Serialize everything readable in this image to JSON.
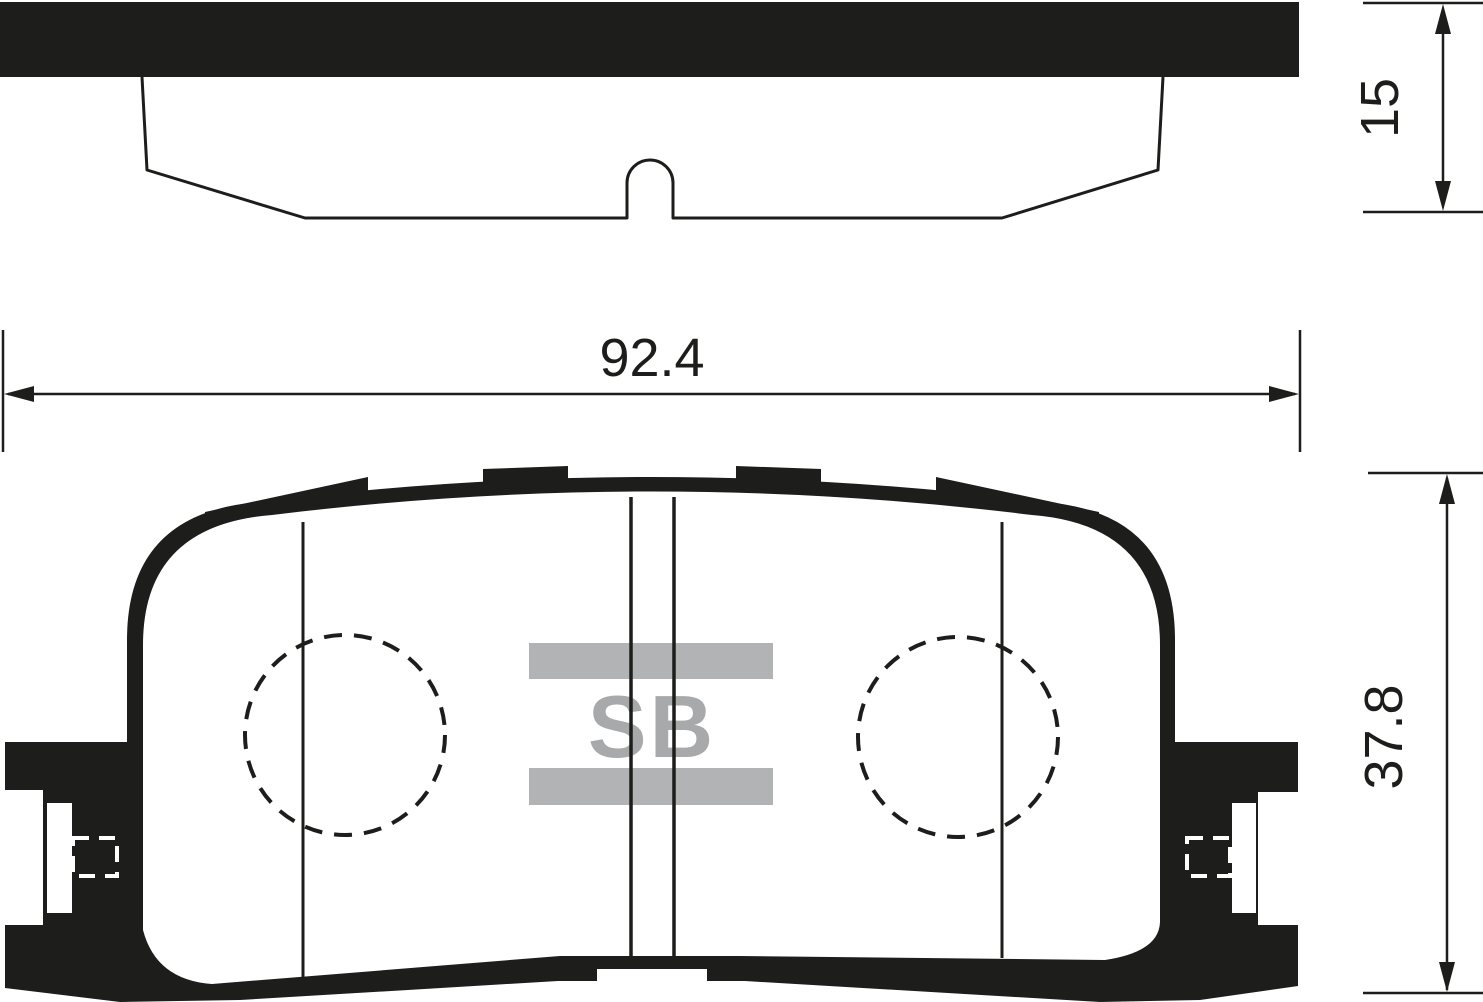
{
  "drawing": {
    "title": "Brake pad technical drawing",
    "ink_color": "#1d1d1b",
    "background_color": "#ffffff",
    "logo": {
      "text": "SB",
      "bar_color": "#b1b3b4",
      "text_color": "#a7a9ab"
    },
    "views": {
      "side_view": "backing plate with friction material profile and center slot bump",
      "front_view": "pad face with two dashed locating circles, center wear slots, side ears with retainer slots and bottom center notch"
    },
    "dimensions": {
      "width_mm": "92.4",
      "thickness_mm": "15",
      "height_mm": "37.8"
    }
  }
}
